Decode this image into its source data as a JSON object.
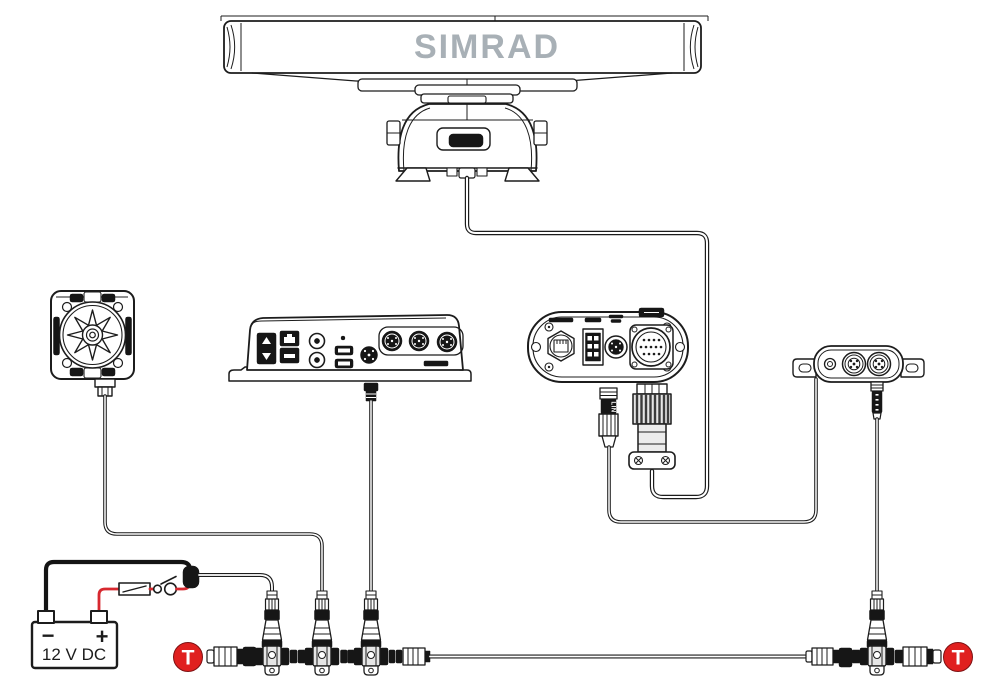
{
  "colors": {
    "accent_red": "#e0201f",
    "accent_red_edge": "#7d1113",
    "logo_gray": "#a8b0b6",
    "line": "#1c1c1c"
  },
  "radar": {
    "brand": "SIMRAD"
  },
  "power": {
    "battery_label": "12 V DC",
    "minus_symbol": "−",
    "plus_symbol": "+"
  },
  "backbone": {
    "terminator_left_symbol": "T",
    "terminator_right_symbol": "T"
  },
  "interface": {
    "lin_label": "LIN"
  }
}
